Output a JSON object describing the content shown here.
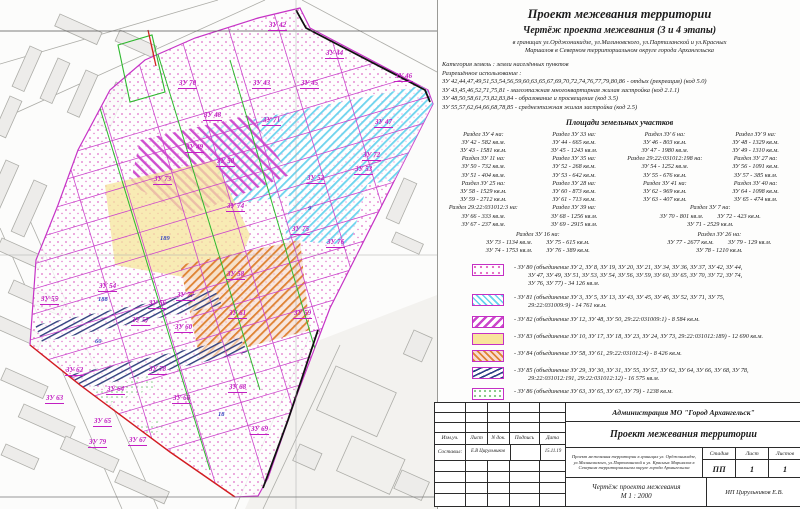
{
  "colors": {
    "parcel_line": "#c21fc2",
    "quarter_label": "#3a49c0",
    "red_boundary": "#d42020",
    "black_boundary": "#111111",
    "green_line": "#2eb82e"
  },
  "header": {
    "title": "Проект межевания территории",
    "subtitle": "Чертёж проекта межевания (3 и 4 этапы)",
    "addr1": "в границах ул.Орджоникидзе, ул.Малиновского, ул.Партизанской и ул.Красных",
    "addr2": "Маршалов в Северном территориальном округе города Архангельска"
  },
  "land_info": {
    "category": "Категория земель : земли населённых пунктов",
    "permitted_label": "Разрешённое использование :",
    "uses": [
      "ЗУ 42,44,47,49,51,53,54,56,59,60,63,65,67,69,70,72,74,76,77,79,80,86  -  отдых (рекреация) (код 5.0)",
      "ЗУ 43,45,46,52,71,75,81  -  малоэтажная многоквартирная жилая застройка  (код 2.1.1)",
      "ЗУ 48,50,58,61,73,82,83,84  -  образование и просвещение  (код 3.5)",
      "ЗУ 55,57,62,64,66,68,78,85  -  среднеэтажная жилая застройка  (код 2.5)"
    ]
  },
  "areas": {
    "title": "Площади земельных участков",
    "columns": [
      [
        "Раздел ЗУ 4 на:",
        "ЗУ 42 - 582 кв.м.",
        "ЗУ 43 - 1581 кв.м.",
        "Раздел ЗУ 11 на:",
        "ЗУ 50 - 732 кв.м.",
        "ЗУ 51 - 404 кв.м.",
        "Раздел ЗУ 25 на:",
        "ЗУ 58 - 1529 кв.м.",
        "ЗУ 59 - 2712 кв.м.",
        "Раздел 29:22:031012:3 на:",
        "ЗУ 66 - 333 кв.м.",
        "ЗУ 67 - 237 кв.м."
      ],
      [
        "Раздел ЗУ 33 на:",
        "ЗУ 44 - 665 кв.м.",
        "ЗУ 45 - 1243 кв.м.",
        "Раздел ЗУ 35 на:",
        "ЗУ 52 - 268 кв.м.",
        "ЗУ 53 - 642 кв.м.",
        "Раздел ЗУ 28 на:",
        "ЗУ 60 - 873 кв.м.",
        "ЗУ 61 - 713 кв.м.",
        "Раздел ЗУ 39 на:",
        "ЗУ 68 - 1256 кв.м.",
        "ЗУ 69 - 2915 кв.м."
      ],
      [
        "Раздел ЗУ 6 на:",
        "ЗУ 46 - 803 кв.м.",
        "ЗУ 47 - 1980 кв.м.",
        "Раздел 29:22:031012:198 на:",
        "ЗУ 54 - 1252 кв.м.",
        "ЗУ 55 - 676 кв.м.",
        "Раздел ЗУ 41 на:",
        "ЗУ 62 - 969 кв.м.",
        "ЗУ 63 - 407 кв.м."
      ],
      [
        "Раздел ЗУ 9 на:",
        "ЗУ 48 - 1329 кв.м.",
        "ЗУ 49 - 1310 кв.м.",
        "Раздел ЗУ 27 на:",
        "ЗУ 56 - 1091 кв.м.",
        "ЗУ 57 - 385 кв.м.",
        "Раздел ЗУ 40 на:",
        "ЗУ 64 - 1098 кв.м.",
        "ЗУ 65 - 474 кв.м."
      ]
    ],
    "group7": {
      "header": "Раздел ЗУ 7 на:",
      "r1a": "ЗУ 70 - 801 кв.м.",
      "r1b": "ЗУ 72 - 423 кв.м.",
      "r2a": "ЗУ 71 - 2529 кв.м."
    },
    "group16": {
      "header": "Раздел ЗУ 16 на:",
      "r1a": "ЗУ 73 - 1134 кв.м.",
      "r1b": "ЗУ 75 - 615 кв.м.",
      "r2a": "ЗУ 74 - 1753 кв.м.",
      "r2b": "ЗУ 76 - 389 кв.м."
    },
    "group26": {
      "header": "Раздел ЗУ 26 на:",
      "r1a": "ЗУ 77 - 2677 кв.м.",
      "r1b": "ЗУ 79 - 129 кв.м.",
      "r2a": "ЗУ 78 - 1210 кв.м."
    }
  },
  "legend": {
    "items": [
      {
        "swatch": "pink-dots",
        "lines": [
          "- ЗУ 80 (объединение ЗУ 2, ЗУ 8, ЗУ 19, ЗУ 20, ЗУ 21, ЗУ 34, ЗУ 36, ЗУ 37, ЗУ 42, ЗУ 44,",
          "ЗУ 47, ЗУ 49, ЗУ 51, ЗУ 53, ЗУ 54, ЗУ 56, ЗУ 59, ЗУ 60, ЗУ 65, ЗУ 70, ЗУ 72, ЗУ 74,",
          "ЗУ 76, ЗУ 77) - 34 126 кв.м."
        ]
      },
      {
        "swatch": "cyan-hatch",
        "lines": [
          "- ЗУ 81 (объединение ЗУ 3, ЗУ 5, ЗУ 13, ЗУ 43, ЗУ 45, ЗУ 46, ЗУ 52, ЗУ 71, ЗУ 75,",
          "29:22:031009:9) - 14 761 кв.м."
        ]
      },
      {
        "swatch": "magenta-hatch",
        "lines": [
          "- ЗУ 82 (объединение ЗУ 12, ЗУ 48, ЗУ 50, 29:22:031009:1) - 8 584 кв.м."
        ]
      },
      {
        "swatch": "yellow-solid",
        "lines": [
          "- ЗУ 83 (объединение ЗУ 10, ЗУ 17, ЗУ 18, ЗУ 23, ЗУ 24, ЗУ 73, 29:22:031012:189) - 12 690 кв.м."
        ]
      },
      {
        "swatch": "orange-hatch",
        "lines": [
          "- ЗУ 84 (объединение ЗУ 58, ЗУ 61, 29:22:031012:4) - 8 426 кв.м."
        ]
      },
      {
        "swatch": "navy-crosshatch",
        "lines": [
          "- ЗУ 85 (объединение ЗУ 29, ЗУ 30, ЗУ 31, ЗУ 55, ЗУ 57,  ЗУ 62, ЗУ 64, ЗУ 66, ЗУ 68, ЗУ 78,",
          "29:22:031012:191, 29:22:031012:12) - 16 575 кв.м."
        ]
      },
      {
        "swatch": "green-dots",
        "lines": [
          "- ЗУ 86 (объединение ЗУ 63, ЗУ 65, ЗУ 67, ЗУ 79) - 1238 кв.м."
        ]
      }
    ]
  },
  "titleblock": {
    "org": "Администрация МО \"Город Архангельск\"",
    "project": "Проект межевания территории",
    "cols": [
      "Изм.уч.",
      "Лист",
      "N док.",
      "Подпись",
      "Дата"
    ],
    "composed_label": "Составил:",
    "composed_name": "Е.В Цирульников",
    "composed_date": "15.11.19",
    "desc1": "Проект межевания территории в границах ул. Орджоникидзе,",
    "desc2": "ул.Малиновского, ул.Партизанской и ул. Красных Маршалов в",
    "desc3": "Северном территориальном округе города Архангельска",
    "stage_label": "Стадия",
    "sheet_label": "Лист",
    "sheets_label": "Листов",
    "stage": "ПП",
    "sheet": "1",
    "sheets": "1",
    "drawing_title": "Чертёж проекта межевания",
    "scale": "М 1 : 2000",
    "author": "ИП Цирульников Е.В."
  },
  "map": {
    "parcel_labels": [
      {
        "t": "ЗУ 42",
        "x": 268,
        "y": 22
      },
      {
        "t": "ЗУ 44",
        "x": 325,
        "y": 50
      },
      {
        "t": "ЗУ 46",
        "x": 394,
        "y": 73
      },
      {
        "t": "ЗУ 70",
        "x": 178,
        "y": 80
      },
      {
        "t": "ЗУ 43",
        "x": 252,
        "y": 80
      },
      {
        "t": "ЗУ 45",
        "x": 300,
        "y": 80
      },
      {
        "t": "ЗУ 48",
        "x": 203,
        "y": 112
      },
      {
        "t": "ЗУ 71",
        "x": 262,
        "y": 117
      },
      {
        "t": "ЗУ 47",
        "x": 374,
        "y": 119
      },
      {
        "t": "ЗУ 49",
        "x": 185,
        "y": 144
      },
      {
        "t": "ЗУ 50",
        "x": 216,
        "y": 158
      },
      {
        "t": "ЗУ 72",
        "x": 362,
        "y": 152
      },
      {
        "t": "ЗУ 53",
        "x": 354,
        "y": 166
      },
      {
        "t": "ЗУ 52",
        "x": 306,
        "y": 175
      },
      {
        "t": "ЗУ 73",
        "x": 153,
        "y": 176
      },
      {
        "t": "ЗУ 74",
        "x": 226,
        "y": 203
      },
      {
        "t": "ЗУ 75",
        "x": 291,
        "y": 226
      },
      {
        "t": "ЗУ 76",
        "x": 326,
        "y": 239
      },
      {
        "t": "ЗУ 58",
        "x": 226,
        "y": 271
      },
      {
        "t": "ЗУ 54",
        "x": 98,
        "y": 283
      },
      {
        "t": "ЗУ 55",
        "x": 40,
        "y": 296
      },
      {
        "t": "ЗУ 77",
        "x": 176,
        "y": 292
      },
      {
        "t": "ЗУ 56",
        "x": 148,
        "y": 300
      },
      {
        "t": "ЗУ 57",
        "x": 131,
        "y": 317
      },
      {
        "t": "ЗУ 61",
        "x": 228,
        "y": 310
      },
      {
        "t": "ЗУ 59",
        "x": 293,
        "y": 310
      },
      {
        "t": "ЗУ 60",
        "x": 174,
        "y": 324
      },
      {
        "t": "ЗУ 62",
        "x": 65,
        "y": 367
      },
      {
        "t": "ЗУ 78",
        "x": 148,
        "y": 366
      },
      {
        "t": "ЗУ 64",
        "x": 106,
        "y": 386
      },
      {
        "t": "ЗУ 63",
        "x": 45,
        "y": 395
      },
      {
        "t": "ЗУ 66",
        "x": 172,
        "y": 395
      },
      {
        "t": "ЗУ 68",
        "x": 228,
        "y": 384
      },
      {
        "t": "ЗУ 65",
        "x": 93,
        "y": 418
      },
      {
        "t": "ЗУ 79",
        "x": 88,
        "y": 439
      },
      {
        "t": "ЗУ 67",
        "x": 128,
        "y": 437
      },
      {
        "t": "ЗУ 69",
        "x": 250,
        "y": 426
      }
    ],
    "quarter_labels": [
      {
        "t": "189",
        "x": 160,
        "y": 236
      },
      {
        "t": "188",
        "x": 98,
        "y": 297
      },
      {
        "t": "60",
        "x": 95,
        "y": 339
      },
      {
        "t": "9",
        "x": 308,
        "y": 206
      },
      {
        "t": "18",
        "x": 218,
        "y": 412
      }
    ]
  }
}
